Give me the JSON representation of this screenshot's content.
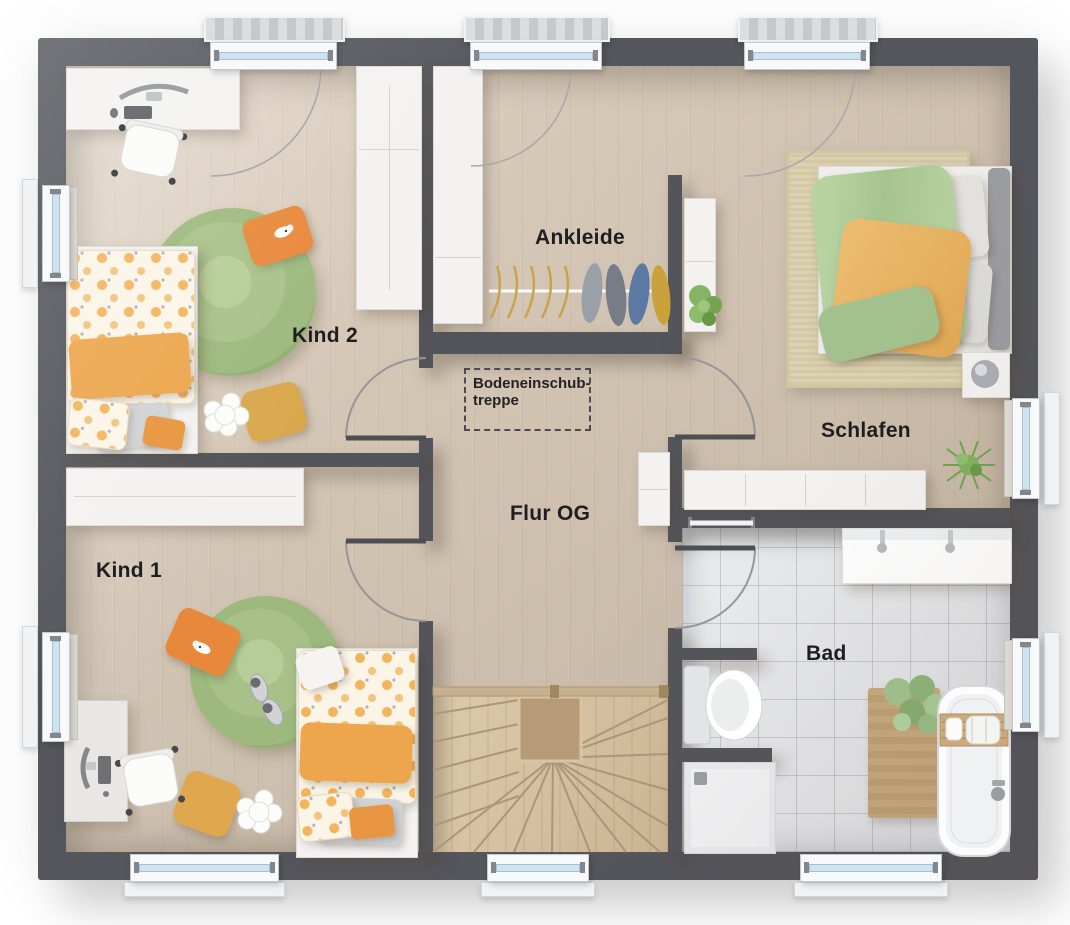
{
  "plan_type": "floor-plan-upper-storey",
  "rooms": {
    "kind2": {
      "label": "Kind 2"
    },
    "kind1": {
      "label": "Kind 1"
    },
    "ankleide": {
      "label": "Ankleide"
    },
    "schlafen": {
      "label": "Schlafen"
    },
    "flur": {
      "label": "Flur OG"
    },
    "bad": {
      "label": "Bad"
    }
  },
  "annotations": {
    "attic_stairs_note": {
      "line1": "Bodeneinschub-",
      "line2": "treppe"
    }
  },
  "colors": {
    "wall": "#55565c",
    "wood_floor": "#d6c8b7",
    "stair_wood": "#d2bfa1",
    "tile_floor": "#e6e7e9",
    "rug_green": "#a9c289",
    "bedding_orange": "#eda64c",
    "bedding_dot_cream": "#fbf5e7",
    "duvet_green": "#aecb97",
    "duvet_orange": "#e7b264",
    "furniture_white": "#f3f2f0",
    "window_glass": "#cfe3f0",
    "label_text": "#1e1e20"
  }
}
